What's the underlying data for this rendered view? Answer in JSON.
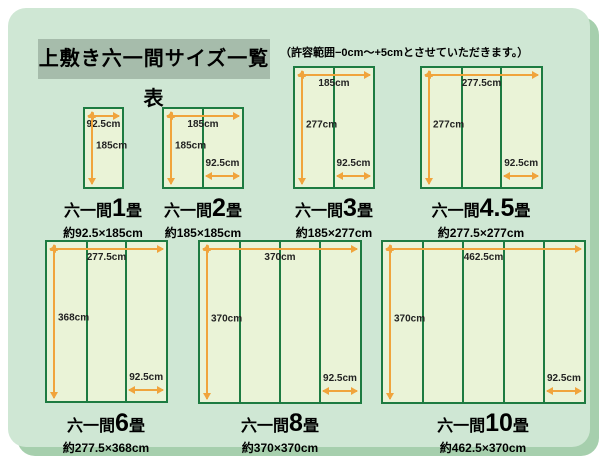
{
  "title": "上敷き六一間サイズ一覧表",
  "note": "（許容範囲−0cm〜+5cmとさせていただきます。）",
  "unit": "cm",
  "colors": {
    "page_bg": "#ffffff",
    "panel_bg": "#cfe7d4",
    "panel_shadow": "#a6cfad",
    "title_bg": "#a6bcab",
    "mat_border": "#1d7b41",
    "mat_fill": "#eaf3d7",
    "arrow": "#f0a43c",
    "text": "#111111"
  },
  "diagrams": [
    {
      "id": "1jo",
      "name_prefix": "六一間",
      "number": "1",
      "name_suffix": "畳",
      "size_label": "約92.5×185cm",
      "width_cm": 92.5,
      "height_cm": 185,
      "panels": 1,
      "width_label": "92.5cm",
      "height_label": "185cm",
      "panel_label": null
    },
    {
      "id": "2jo",
      "name_prefix": "六一間",
      "number": "2",
      "name_suffix": "畳",
      "size_label": "約185×185cm",
      "width_cm": 185,
      "height_cm": 185,
      "panels": 2,
      "width_label": "185cm",
      "height_label": "185cm",
      "panel_label": "92.5cm"
    },
    {
      "id": "3jo",
      "name_prefix": "六一間",
      "number": "3",
      "name_suffix": "畳",
      "size_label": "約185×277cm",
      "width_cm": 185,
      "height_cm": 277,
      "panels": 2,
      "width_label": "185cm",
      "height_label": "277cm",
      "panel_label": "92.5cm"
    },
    {
      "id": "4-5jo",
      "name_prefix": "六一間",
      "number": "4.5",
      "name_suffix": "畳",
      "size_label": "約277.5×277cm",
      "width_cm": 277.5,
      "height_cm": 277,
      "panels": 3,
      "width_label": "277.5cm",
      "height_label": "277cm",
      "panel_label": "92.5cm"
    },
    {
      "id": "6jo",
      "name_prefix": "六一間",
      "number": "6",
      "name_suffix": "畳",
      "size_label": "約277.5×368cm",
      "width_cm": 277.5,
      "height_cm": 368,
      "panels": 3,
      "width_label": "277.5cm",
      "height_label": "368cm",
      "panel_label": "92.5cm"
    },
    {
      "id": "8jo",
      "name_prefix": "六一間",
      "number": "8",
      "name_suffix": "畳",
      "size_label": "約370×370cm",
      "width_cm": 370,
      "height_cm": 370,
      "panels": 4,
      "width_label": "370cm",
      "height_label": "370cm",
      "panel_label": "92.5cm"
    },
    {
      "id": "10jo",
      "name_prefix": "六一間",
      "number": "10",
      "name_suffix": "畳",
      "size_label": "約462.5×370cm",
      "width_cm": 462.5,
      "height_cm": 370,
      "panels": 5,
      "width_label": "462.5cm",
      "height_label": "370cm",
      "panel_label": "92.5cm"
    }
  ]
}
